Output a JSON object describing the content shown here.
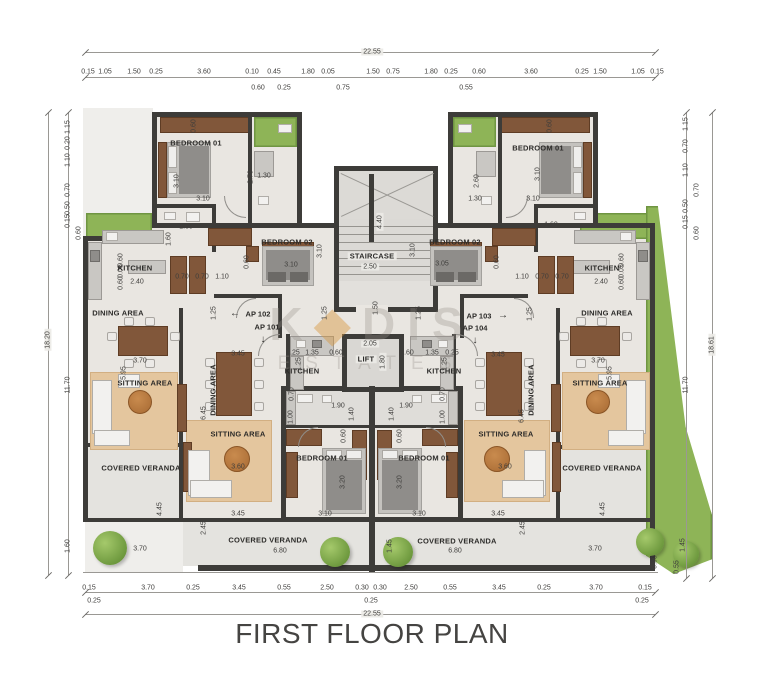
{
  "meta": {
    "title": "FIRST FLOOR PLAN"
  },
  "watermark": {
    "k": "K",
    "diamond": "◆",
    "dis": "DIS",
    "line2": "ESTATES"
  },
  "apartments": {
    "ap101": "AP 101",
    "ap102": "AP 102",
    "ap103": "AP 103",
    "ap104": "AP 104",
    "arrow_left": "←",
    "arrow_right": "→",
    "arrow_down": "↓"
  },
  "rooms": [
    "BEDROOM 01",
    "BEDROOM 02",
    "KITCHEN",
    "DINING AREA",
    "SITTING AREA",
    "COVERED VERANDA",
    "STAIRCASE",
    "LIFT",
    "KITCHEN",
    "DINING AREA",
    "SITTING AREA",
    "BEDROOM 01",
    "COVERED VERANDA",
    "BEDROOM 01",
    "SITTING AREA",
    "DINING AREA",
    "KITCHEN",
    "COVERED VERANDA",
    "BEDROOM 01",
    "BEDROOM 02",
    "KITCHEN",
    "DINING AREA",
    "SITTING AREA",
    "COVERED VERANDA"
  ],
  "dims": {
    "top_total": "22.55",
    "bottom_total": "22.55",
    "left_total": "18.20",
    "right_total": "18.61",
    "top": [
      "0.15",
      "1.05",
      "1.50",
      "0.25",
      "3.60",
      "0.10",
      "0.45",
      "1.80",
      "0.05",
      "1.50",
      "0.75",
      "1.80",
      "0.25",
      "0.60",
      "3.60",
      "0.25",
      "1.50",
      "1.05",
      "0.15"
    ],
    "top_sub": [
      "0.60",
      "0.25",
      "0.75",
      "0.55"
    ],
    "bottom": [
      "0.15",
      "0.25",
      "3.70",
      "0.25",
      "3.45",
      "0.55",
      "2.50",
      "0.30",
      "0.30",
      "0.25",
      "2.50",
      "0.55",
      "3.45",
      "0.25",
      "3.70",
      "0.15",
      "0.25"
    ],
    "left": [
      "1.15",
      "0.20",
      "1.10",
      "0.70",
      "0.50",
      "0.15",
      "0.60",
      "11.70",
      "1.60"
    ],
    "right": [
      "1.15",
      "0.70",
      "1.10",
      "0.70",
      "0.50",
      "0.15",
      "0.60",
      "11.70"
    ],
    "interior": [
      "0.60",
      "3.10",
      "3.10",
      "2.70",
      "1.30",
      "1.60",
      "1.60",
      "3.10",
      "3.10",
      "0.60",
      "2.40",
      "0.60",
      "0.05",
      "0.60",
      "0.70",
      "0.70",
      "1.10",
      "3.70",
      "5.95",
      "1.25",
      "3.45",
      "6.45",
      "3.60",
      "4.45",
      "3.70",
      "2.45",
      "3.45",
      "6.80",
      "2.50",
      "4.40",
      "1.50",
      "1.25",
      "1.25",
      "2.05",
      "1.80",
      "0.25",
      "1.35",
      "0.60",
      "0.60",
      "1.35",
      "0.25",
      "1.25",
      "1.25",
      "1.90",
      "1.90",
      "1.40",
      "1.40",
      "1.00",
      "1.00",
      "0.70",
      "0.70",
      "0.60",
      "0.60",
      "3.20",
      "3.20",
      "3.10",
      "3.10",
      "1.45",
      "0.60",
      "3.10",
      "3.10",
      "2.60",
      "1.30",
      "1.60",
      "3.05",
      "3.10",
      "0.60",
      "2.40",
      "0.60",
      "0.05",
      "0.60",
      "1.10",
      "0.70",
      "0.70",
      "3.70",
      "5.95",
      "1.25",
      "3.45",
      "6.45",
      "3.60",
      "4.45",
      "3.70",
      "2.45",
      "3.45",
      "6.80",
      "1.45",
      "0.90",
      "0.55"
    ]
  }
}
